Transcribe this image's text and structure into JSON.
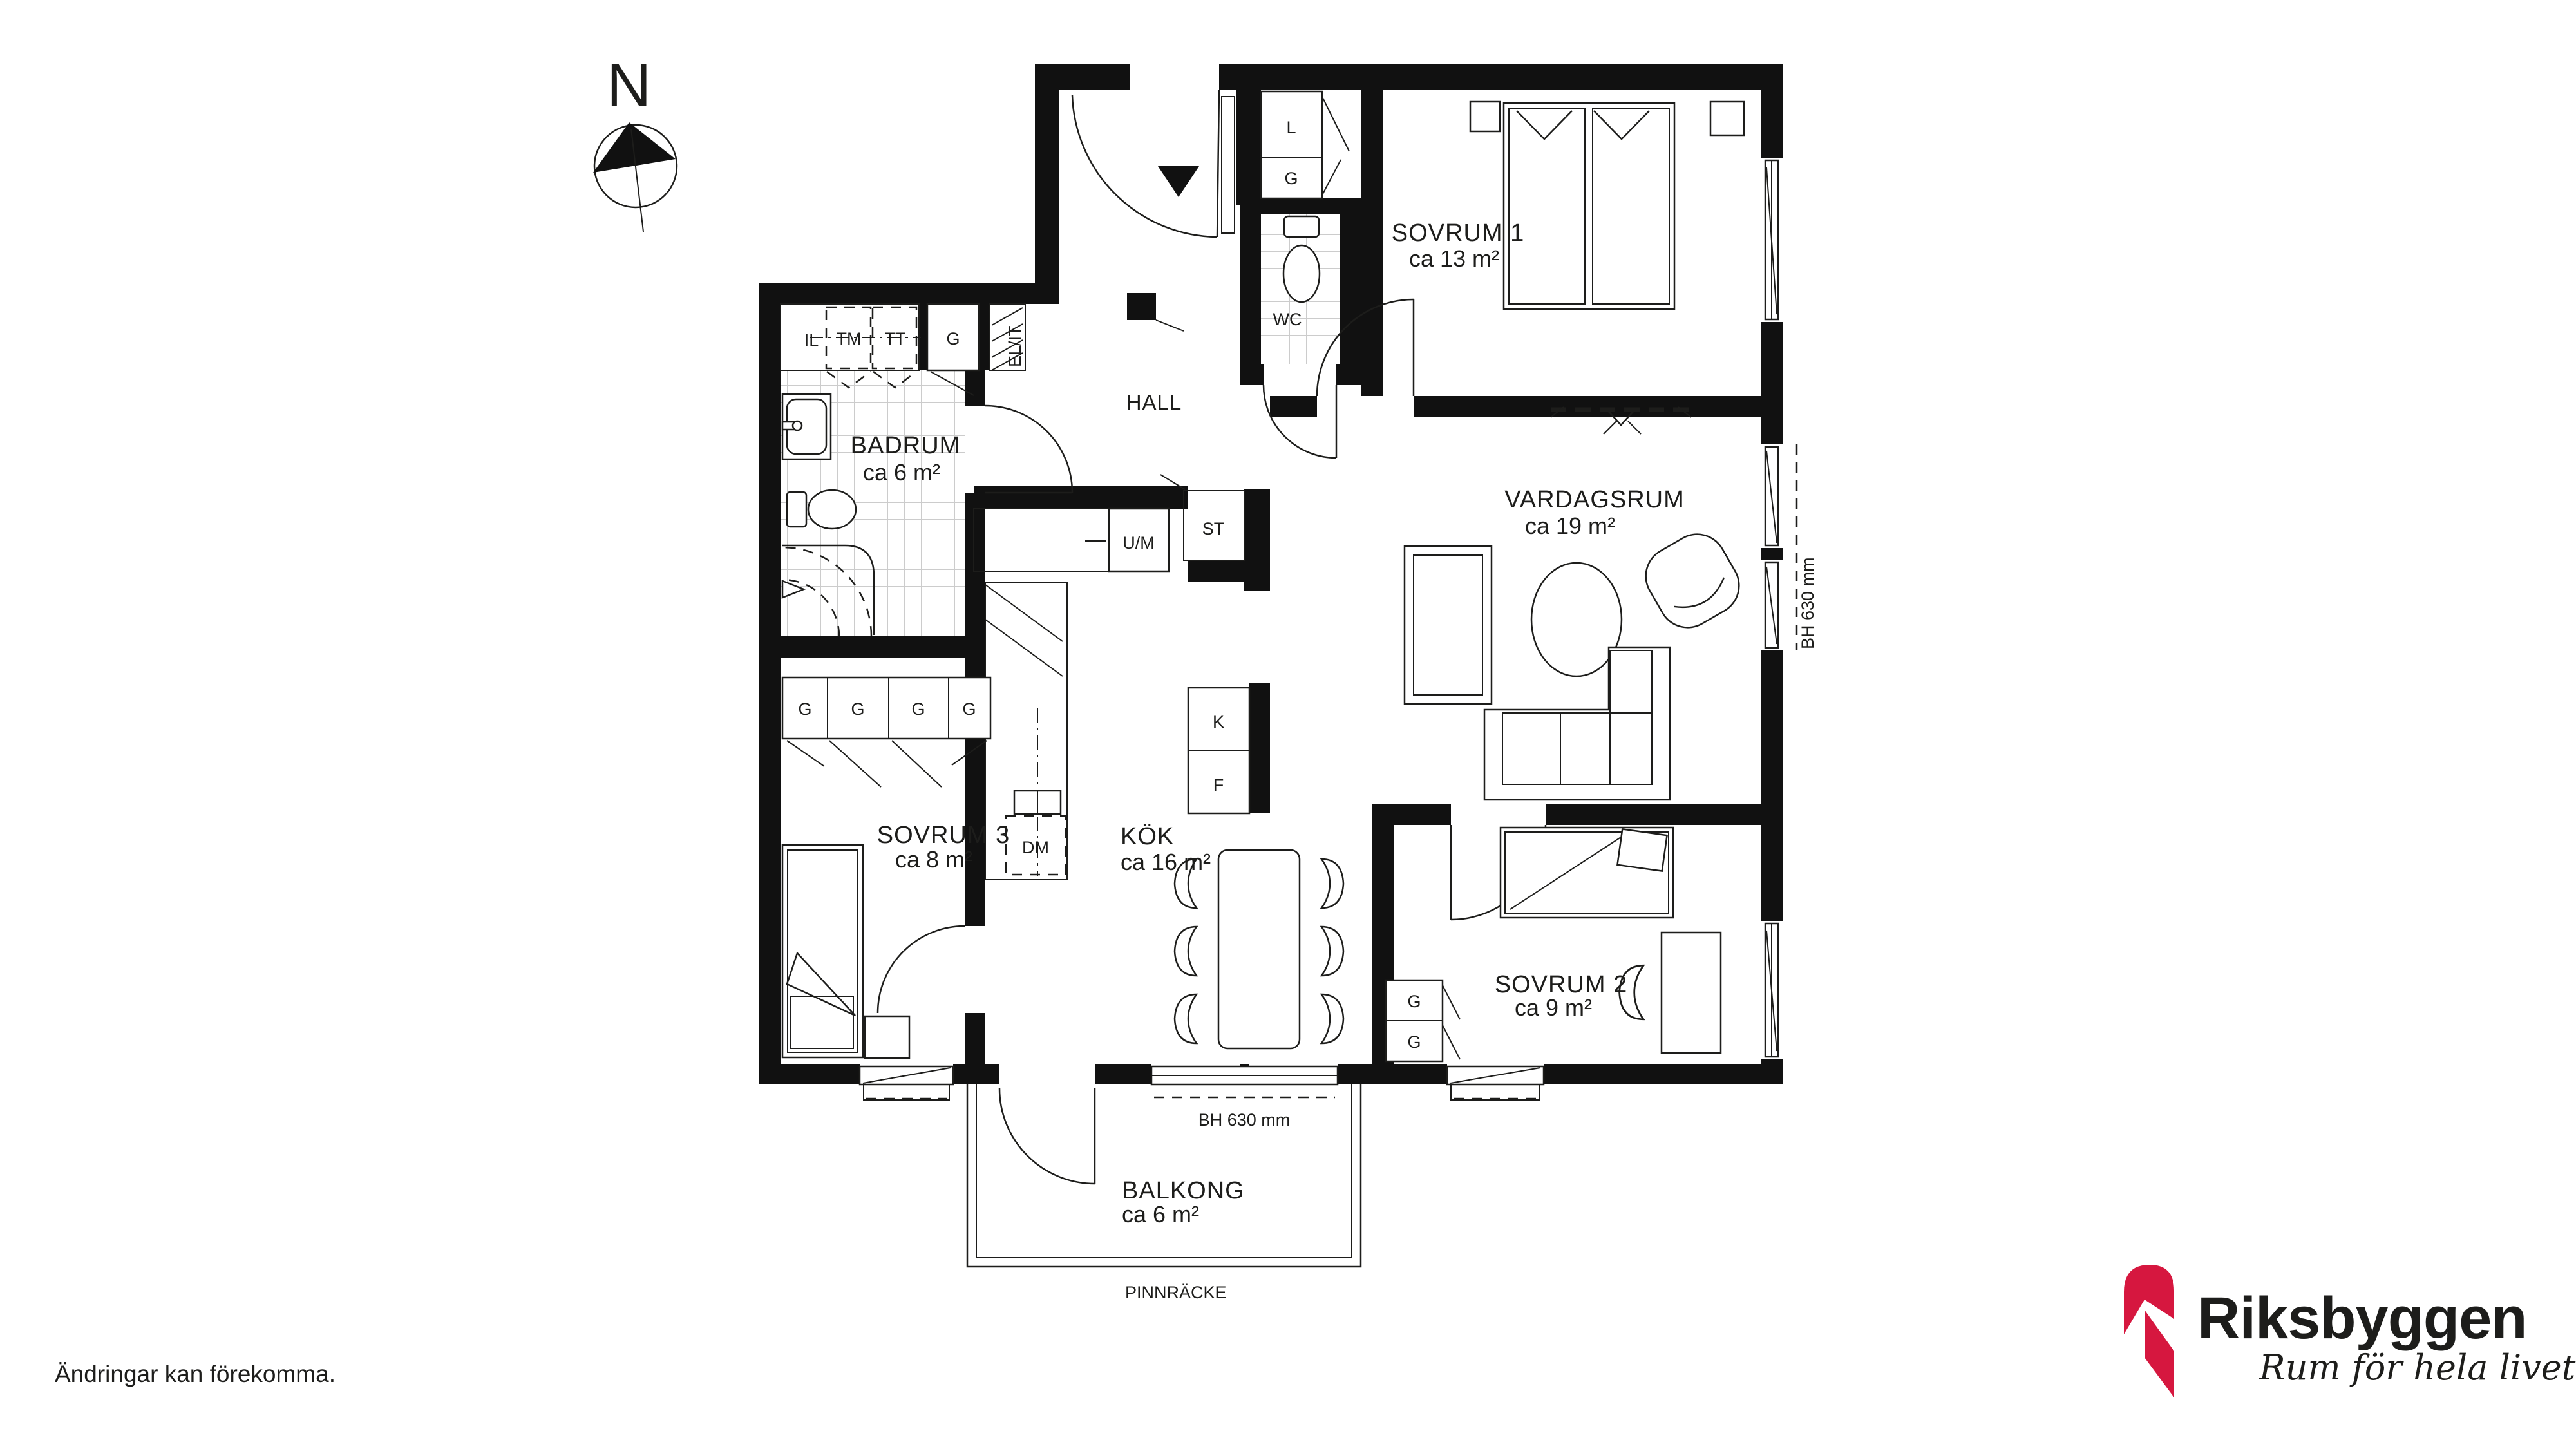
{
  "page": {
    "disclaimer": "Ändringar kan förekomma."
  },
  "compass": {
    "label": "N"
  },
  "rooms": {
    "sovrum1": {
      "name": "SOVRUM 1",
      "area": "ca 13 m²"
    },
    "vardagsrum": {
      "name": "VARDAGSRUM",
      "area": "ca 19 m²"
    },
    "badrum": {
      "name": "BADRUM",
      "area": "ca 6 m²"
    },
    "kok": {
      "name": "KÖK",
      "area": "ca 16 m²"
    },
    "sovrum2": {
      "name": "SOVRUM 2",
      "area": "ca 9 m²"
    },
    "sovrum3": {
      "name": "SOVRUM 3",
      "area": "ca 8 m²"
    },
    "balkong": {
      "name": "BALKONG",
      "area": "ca 6 m²"
    },
    "hall": {
      "name": "HALL"
    },
    "wc": {
      "name": "WC"
    }
  },
  "fixtures": {
    "linen": "L",
    "wardrobe": "G",
    "il": "IL",
    "washer": "TM",
    "dryer": "TT",
    "el_it": "EL/IT",
    "oven_micro": "U/M",
    "cleaning": "ST",
    "fridge": "K",
    "freezer": "F",
    "dishwasher": "DM"
  },
  "annotations": {
    "window_height": "BH 630 mm",
    "railing": "PINNRÄCKE"
  },
  "logo": {
    "brand": "Riksbyggen",
    "tagline": "Rum för hela livet",
    "brand_red": "#D6173F",
    "brand_gray": "#8C8C8C"
  }
}
